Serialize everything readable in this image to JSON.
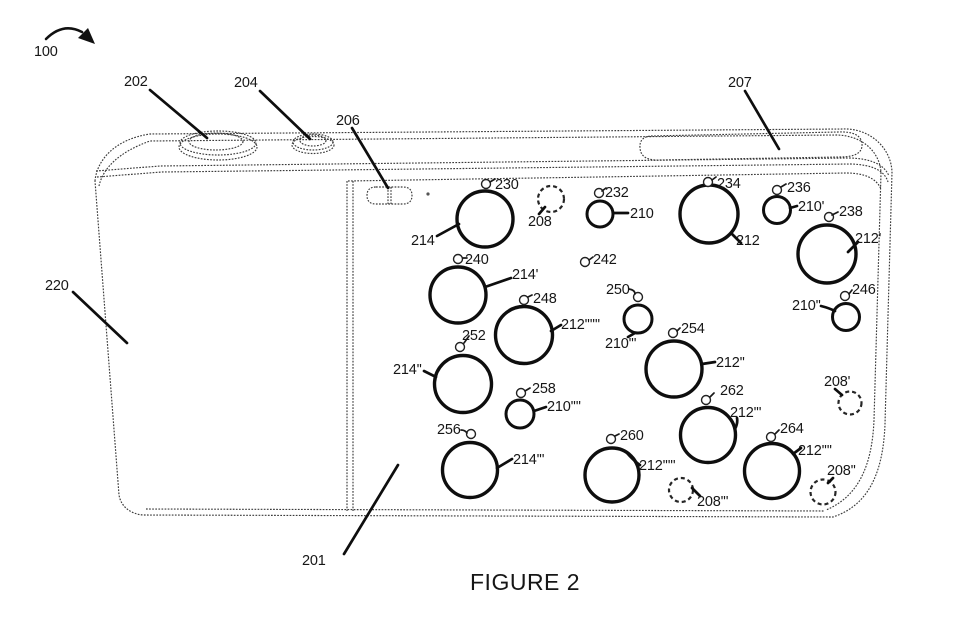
{
  "caption": "FIGURE 2",
  "labels": {
    "overall": "100",
    "front_face": "201",
    "shutter_button": "202",
    "button_204": "204",
    "switch_206": "206",
    "window_207": "207",
    "grip_220": "220",
    "large_modules": [
      "214",
      "214'",
      "214''",
      "214'''"
    ],
    "medium_modules": [
      "212",
      "212'",
      "212''",
      "212'''",
      "212''''",
      "212'''''",
      "212''''''"
    ],
    "small_modules": [
      "210",
      "210'",
      "210''",
      "210'''",
      "210''''"
    ],
    "dashed_modules": [
      "208",
      "208'",
      "208''",
      "208'''"
    ],
    "openings": [
      "230",
      "232",
      "234",
      "236",
      "238",
      "240",
      "242",
      "246",
      "248",
      "250",
      "252",
      "254",
      "256",
      "258",
      "260",
      "262",
      "264"
    ]
  }
}
